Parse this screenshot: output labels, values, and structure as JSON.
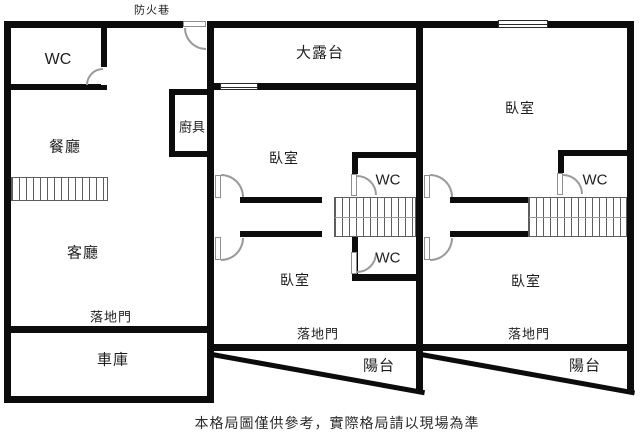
{
  "colors": {
    "wall": "#0c0c0c",
    "text": "#1e1e1e",
    "background": "#ffffff",
    "door_arc": "#9a9a9a"
  },
  "header": {
    "alley_label": "防火巷"
  },
  "footer": {
    "disclaimer": "本格局圖僅供參考，實際格局請以現場為準"
  },
  "unit_left": {
    "wc": "WC",
    "dining": "餐廳",
    "kitchen": "廚具",
    "living": "客廳",
    "patio_door": "落地門",
    "garage": "車庫"
  },
  "unit_middle": {
    "terrace": "大露台",
    "bedroom_upper": "臥室",
    "wc_upper": "WC",
    "bedroom_lower": "臥室",
    "wc_lower": "WC",
    "patio_door": "落地門",
    "balcony": "陽台"
  },
  "unit_right": {
    "bedroom_upper": "臥室",
    "wc": "WC",
    "bedroom_lower": "臥室",
    "patio_door": "落地門",
    "balcony": "陽台"
  }
}
